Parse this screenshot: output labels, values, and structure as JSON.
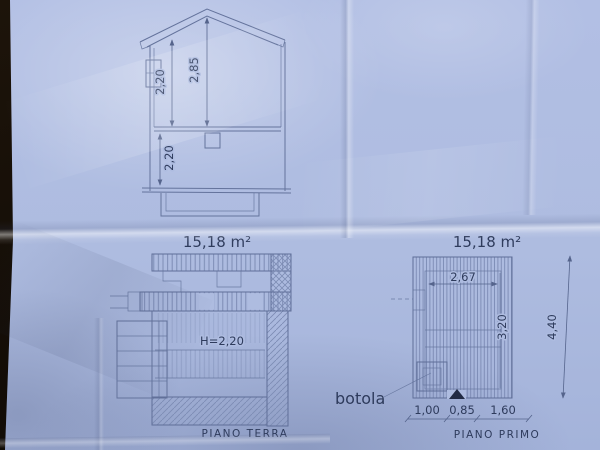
{
  "photo": {
    "paper_color": "#aebce0",
    "line_color": "#64739c",
    "text_color": "#2e3b5c",
    "background_color": "#15100a"
  },
  "section": {
    "dim_wall_height": "2,20",
    "dim_ridge_height": "2,85",
    "dim_lower_height": "2,20"
  },
  "plan_terra": {
    "area_label": "15,18 m²",
    "height_label": "H=2,20",
    "caption": "PIANO TERRA"
  },
  "plan_primo": {
    "area_label": "15,18 m²",
    "dim_width": "2,67",
    "dim_inner_height": "3,20",
    "dim_total_height": "4,40",
    "trapdoor_label": "botola",
    "dim_bottom": [
      "1,00",
      "0,85",
      "1,60"
    ],
    "caption": "PIANO PRIMO"
  }
}
